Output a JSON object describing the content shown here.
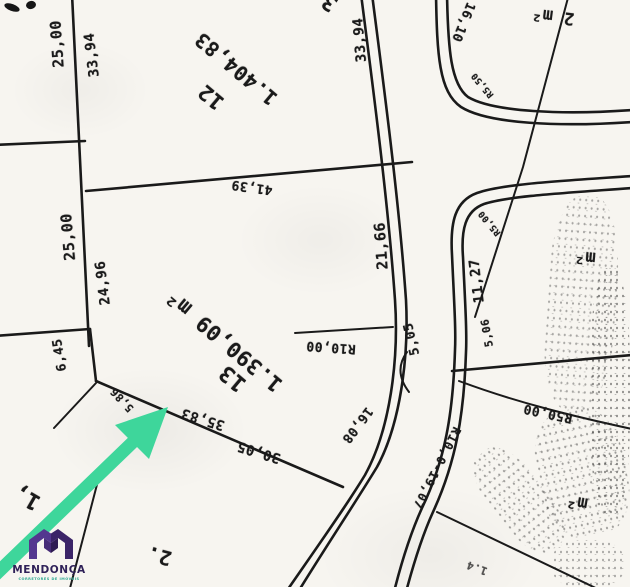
{
  "plat": {
    "lot12": {
      "number": "12",
      "area": "1.404,83"
    },
    "lot13": {
      "number": "13",
      "area": "1.390,09 m²"
    },
    "dims": {
      "d25a": "25,00",
      "d3394L": "33,94",
      "d25b": "25,00",
      "d2496": "24,96",
      "d645": "6,45",
      "d586": "5,86",
      "d3583": "35,83",
      "d3005": "30,05",
      "d4139": "41,39",
      "d2166": "21,66",
      "d3394R": "33,94",
      "d1610": "16,10",
      "r550": "R5,50",
      "r500": "R5,00",
      "d1127": "11,27",
      "d506": "5,06",
      "d505": "5,05",
      "r1000": "R10,00",
      "d1608": "16,08",
      "road_label": "R10,0-19,07",
      "r5000": "R50,00",
      "m2a": "2 m²",
      "m2b": "m²",
      "m2c": "m²",
      "frag2": "2.",
      "frag1": "1,",
      "frag14": "1.4",
      "fragtop": "3"
    },
    "logo": {
      "name": "MENDONÇA",
      "tagline": "corretores de imóveis"
    }
  },
  "colors": {
    "paper": "#f7f5f0",
    "ink": "#1a1a1a",
    "arrow": "#3ed69b",
    "logo_purple": "#53378f",
    "logo_dark": "#3b2468",
    "logo_teal": "#2aa88f",
    "logo_text": "#2f2158"
  }
}
